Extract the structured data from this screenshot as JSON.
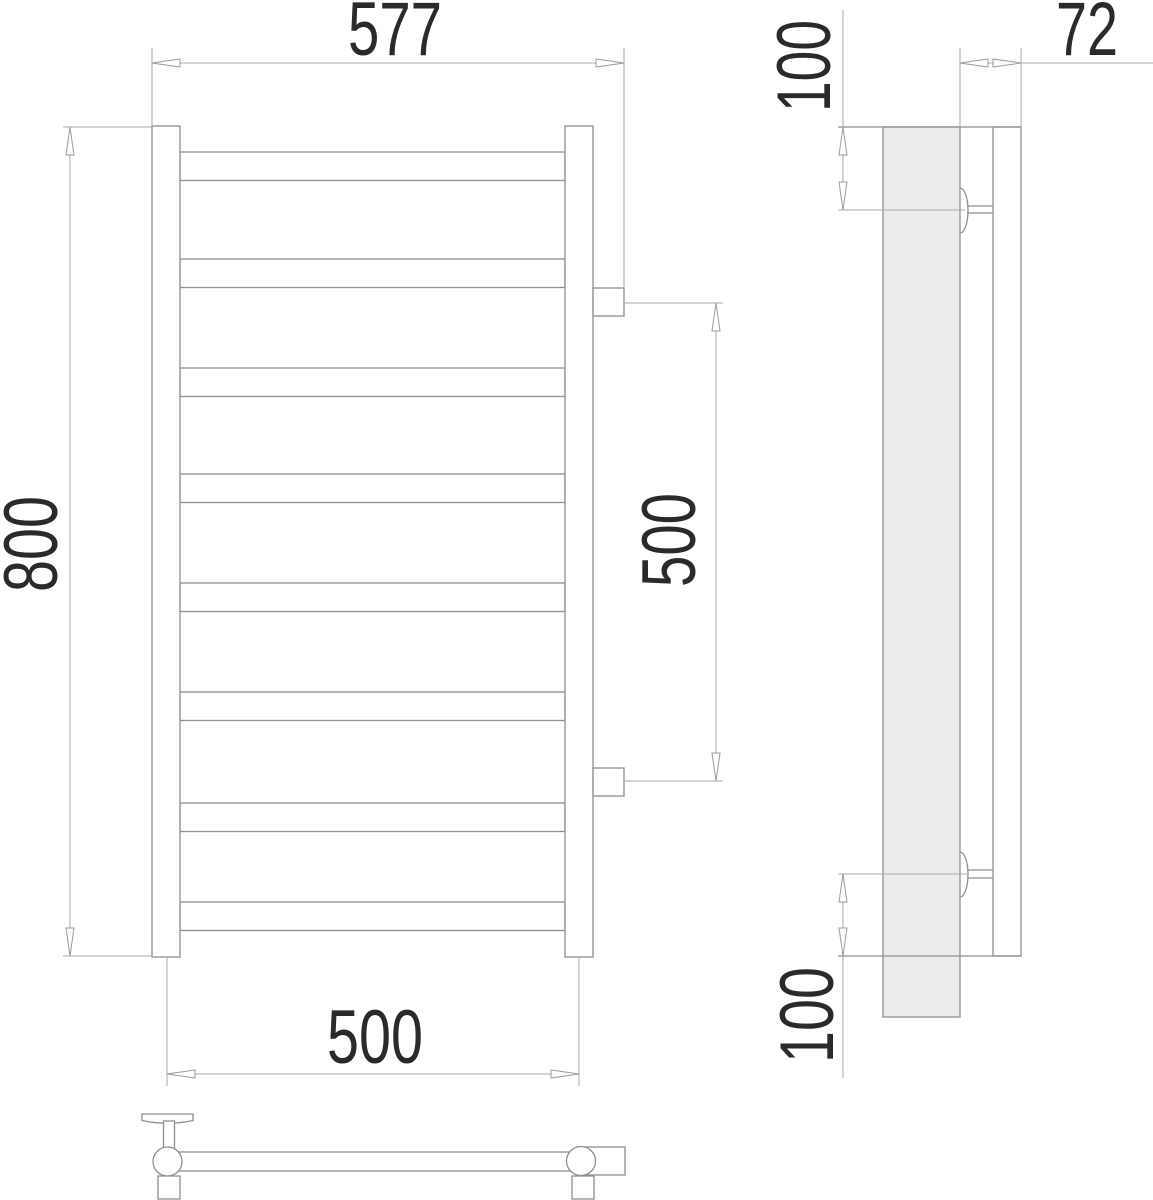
{
  "drawing": {
    "front_view": {
      "overall_width": "577",
      "height": "800",
      "bottom_center_width": "500",
      "connection_spacing": "500",
      "rung_count": 8
    },
    "side_view": {
      "depth": "72",
      "top_connection_offset": "100",
      "bottom_connection_offset": "100"
    },
    "colors": {
      "line": "#8f8f8f",
      "dimension_line": "#a8a8a8",
      "label_text": "#2b2a29",
      "wall_fill": "#ececec",
      "background": "#ffffff"
    }
  }
}
